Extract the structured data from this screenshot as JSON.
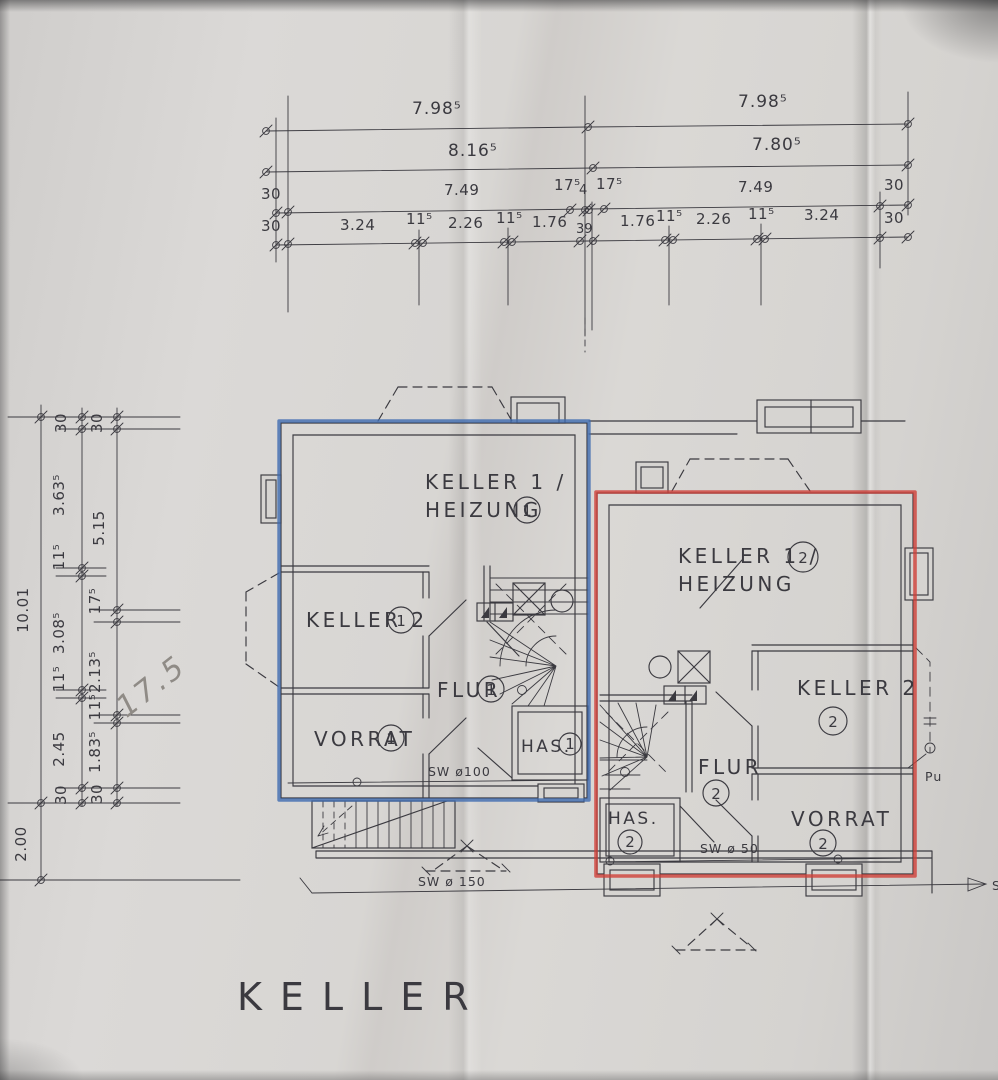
{
  "title": "KELLER",
  "colors": {
    "paper": "#d6d4d1",
    "ink": "#3b3a40",
    "blue": "#3f6cb0",
    "red": "#cf4038",
    "pencil": "#8f8b86"
  },
  "dims": {
    "top": {
      "row1": [
        "7.98⁵",
        "7.98⁵"
      ],
      "row2": [
        "8.16⁵",
        "7.80⁵"
      ],
      "row3": [
        "30",
        "7.49",
        "17⁵",
        "4",
        "17⁵",
        "7.49",
        "30"
      ],
      "row4": [
        "30",
        "3.24",
        "11⁵",
        "2.26",
        "11⁵",
        "1.76",
        "39",
        "1.76",
        "11⁵",
        "2.26",
        "11⁵",
        "3.24",
        "30"
      ]
    },
    "left": {
      "outer": [
        "10.01",
        "2.00"
      ],
      "mid": [
        "30",
        "3.63⁵",
        "11⁵",
        "3.08⁵",
        "11⁵",
        "2.45",
        "30"
      ],
      "inner": [
        "30",
        "5.15",
        "17⁵",
        "2.13⁵",
        "11⁵",
        "1.83⁵",
        "30"
      ]
    },
    "handwritten": "17.5"
  },
  "rooms": {
    "left": {
      "keller1_line1": "KELLER 1 /",
      "keller1_line2": "HEIZUNG",
      "keller1_num": "1",
      "keller2": "KELLER 2",
      "keller2_num": "1",
      "flur": "FLUR",
      "flur_num": "1",
      "vorrat": "VORRAT",
      "vorrat_num": "1",
      "has": "HAS.",
      "has_num": "1"
    },
    "right": {
      "keller1_line1": "KELLER 1 /",
      "keller1_line2": "HEIZUNG",
      "keller1_num": "2",
      "keller2": "KELLER 2",
      "keller2_num": "2",
      "flur": "FLUR",
      "flur_num": "2",
      "vorrat": "VORRAT",
      "vorrat_num": "2",
      "has": "HAS.",
      "has_num": "2"
    }
  },
  "pipes": {
    "sw100": "SW ø100",
    "sw50": "SW ø 50",
    "sw150": "SW ø 150",
    "outfall": "S",
    "pump": "Pu"
  }
}
